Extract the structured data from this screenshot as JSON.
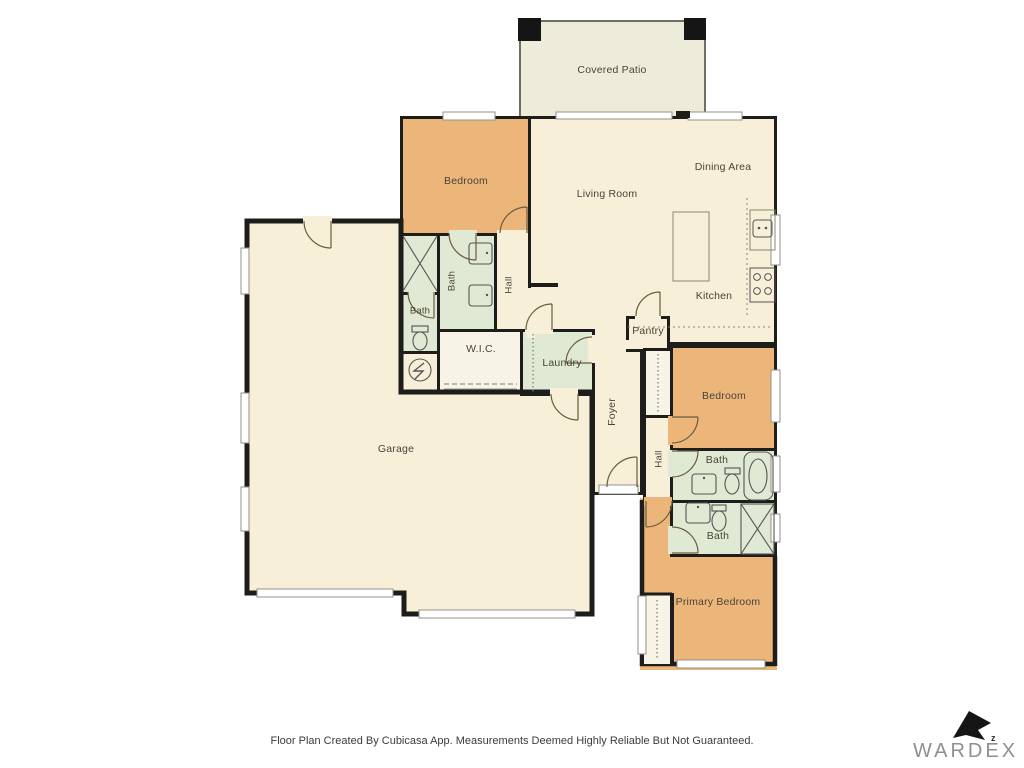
{
  "rooms": {
    "covered_patio": "Covered Patio",
    "bedroom_top_left": "Bedroom",
    "living_room": "Living Room",
    "dining_area": "Dining Area",
    "kitchen": "Kitchen",
    "bath_ensuite": "Bath",
    "hall_upper": "Hall",
    "bath_guest": "Bath",
    "wic": "W.I.C.",
    "laundry": "Laundry",
    "pantry": "Pantry",
    "garage": "Garage",
    "foyer": "Foyer",
    "bedroom_middle": "Bedroom",
    "hall_lower": "Hall",
    "bath_upper_right": "Bath",
    "bath_lower_right": "Bath",
    "primary_bedroom": "Primary Bedroom"
  },
  "footer": {
    "disclaimer": "Floor Plan Created By Cubicasa App. Measurements Deemed Highly Reliable But Not Guaranteed."
  },
  "branding": {
    "name": "WARDEX",
    "mark": "z"
  },
  "colors": {
    "wall": "#1d1d1b",
    "floor": "#f8efd9",
    "bedroom_fill": "#ecb67b",
    "bathroom_fill": "#dfe9d3",
    "patio_fill": "#edecdb",
    "closet_fill": "#f7f3e6"
  }
}
